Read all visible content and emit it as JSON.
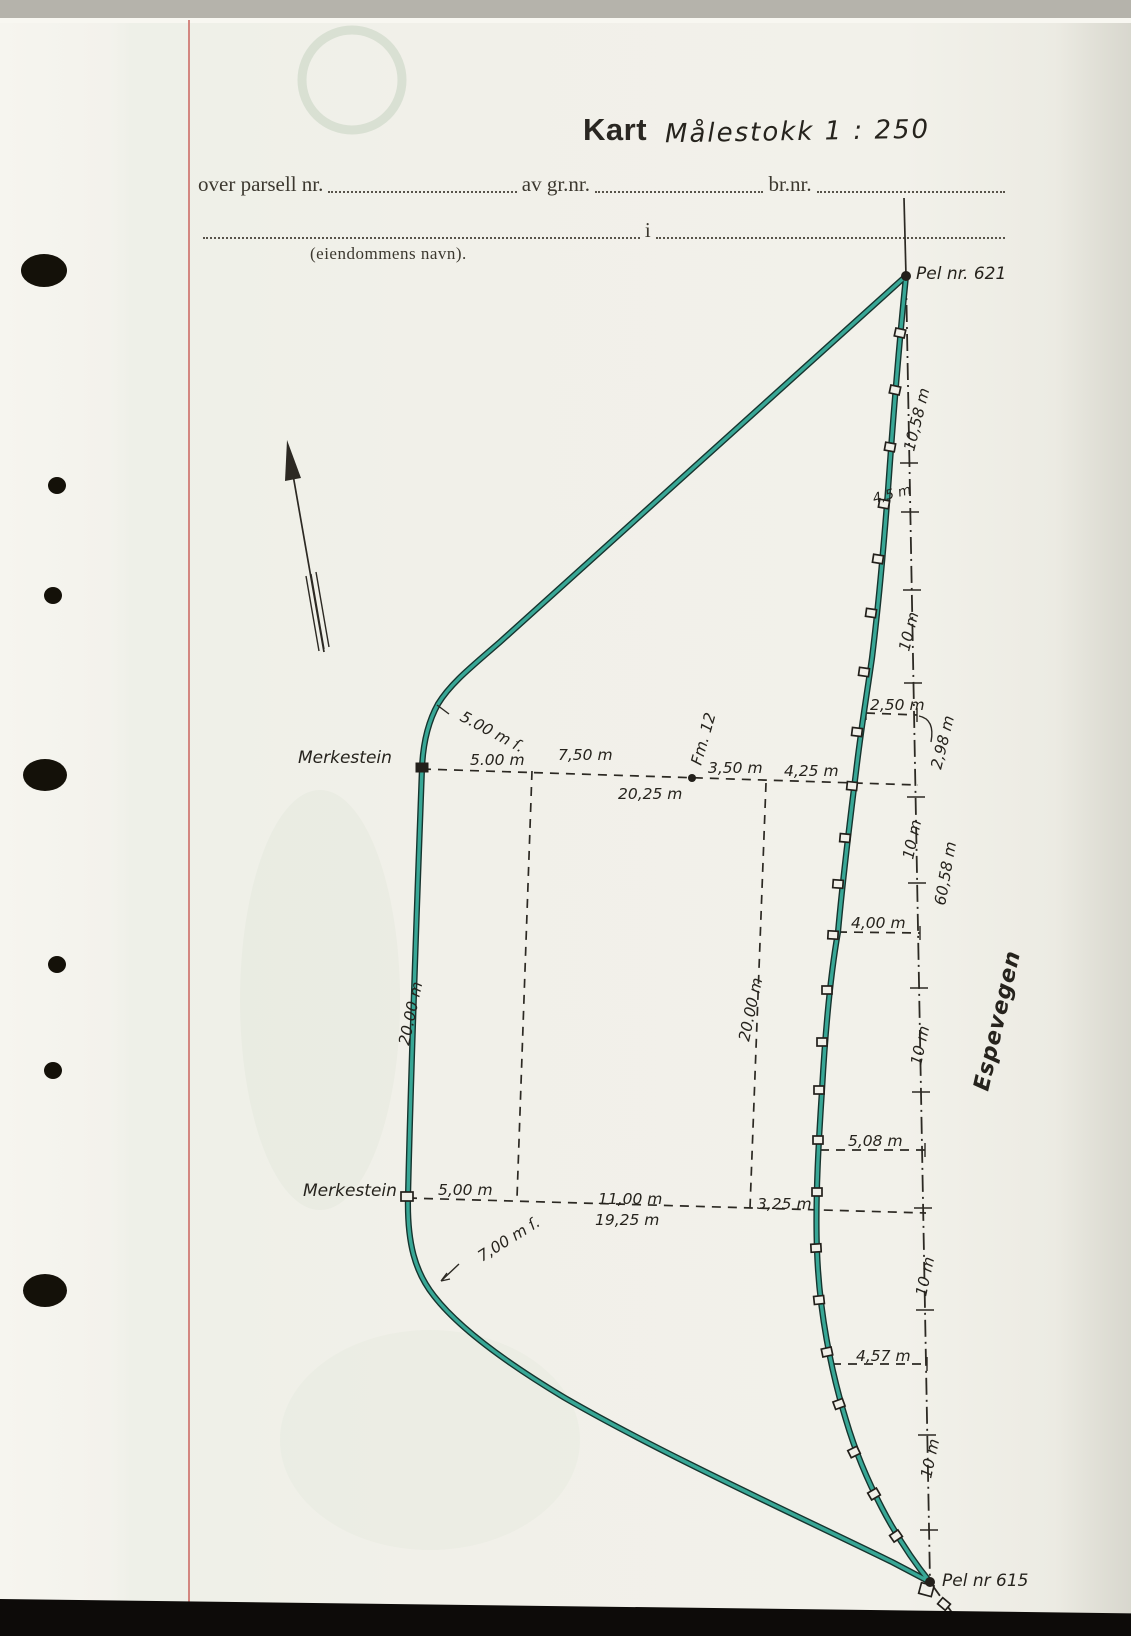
{
  "page": {
    "paper": "#f1f0e9",
    "boundary_teal": "#38a796",
    "margin_red": "#cf7b74",
    "ink": "#2c2923"
  },
  "header": {
    "title": "Kart",
    "scale": "Målestokk 1 : 250"
  },
  "form": {
    "parcel_label": "over parsell nr.",
    "gnr_label": "av gr.nr.",
    "bnr_label": "br.nr.",
    "in_label": "i",
    "name_caption": "(eiendommens navn)."
  },
  "map": {
    "pel_top": "Pel nr. 621",
    "pel_bottom": "Pel nr 615",
    "road_name": "Espevegen",
    "merkestein_top": "Merkestein",
    "merkestein_bottom": "Merkestein",
    "fm_point": "Fm. 12",
    "top_line": {
      "curve": "5.00 m ſ.",
      "seg1": "5.00 m",
      "seg2": "7,50 m",
      "seg3": "3,50 m",
      "seg4": "4,25 m",
      "total": "20,25 m"
    },
    "bottom_line": {
      "curve": "7,00 m ſ.",
      "seg1": "5,00 m",
      "seg2": "11,00 m",
      "seg3": "3,25 m",
      "total": "19,25 m"
    },
    "depth_left": "20.00 m",
    "depth_mid": "20.00 m",
    "road": {
      "s1": "10,58 m",
      "s2": "4,5 m",
      "s3": "10 m",
      "s4": "10 m",
      "s5": "10 m",
      "s6": "10 m",
      "s7": "10 m",
      "total": "60,58 m"
    },
    "offsets": {
      "o1": "2,50 m",
      "o2": "2,98 m",
      "o3": "4,00 m",
      "o4": "5,08 m",
      "o5": "4,57 m"
    }
  }
}
